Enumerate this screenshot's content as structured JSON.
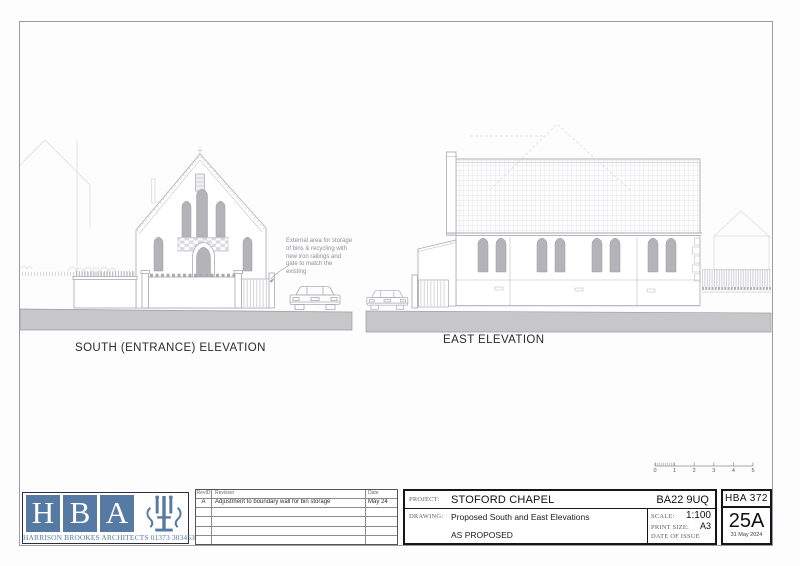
{
  "drawing_area": {
    "south_label": "SOUTH (ENTRANCE) ELEVATION",
    "east_label": "EAST ELEVATION",
    "annotation": "External area for storage of bins & recycling with new iron railings and gate to match the existing",
    "scale_bar_ticks": [
      "0",
      "1",
      "2",
      "3",
      "4",
      "5"
    ]
  },
  "title_block": {
    "logo": {
      "letters": [
        "H",
        "B",
        "A"
      ],
      "firm_line": "HARRISON BROOKES ARCHITECTS 01373 303453",
      "brand_color": "#567AA4"
    },
    "revision_table": {
      "headers": {
        "rev_id": "RevID",
        "revision": "Revision",
        "date": "Date"
      },
      "rows": [
        {
          "rev_id": "A",
          "revision": "Adjustment to boundary wall for bin storage",
          "date": "May 24"
        }
      ]
    },
    "project": {
      "label": "PROJECT:",
      "value": "STOFORD CHAPEL",
      "postcode": "BA22 9UQ"
    },
    "drawing": {
      "label": "DRAWING:",
      "value": "Proposed South and East Elevations",
      "status": "AS PROPOSED"
    },
    "scale": {
      "label": "SCALE:",
      "value": "1:100"
    },
    "print_size": {
      "label": "PRINT SIZE:",
      "value": "A3"
    },
    "date_of_issue": {
      "label": "DATE OF ISSUE"
    },
    "sheet": {
      "job_number": "HBA 372",
      "sheet_number": "25A",
      "issue_date": "31 May 2024"
    }
  },
  "colors": {
    "brand_blue": "#567AA4",
    "line_gray": "#A9A9B2",
    "window_gray": "#B4B4B8",
    "ground_gray": "#C7C7C9"
  }
}
